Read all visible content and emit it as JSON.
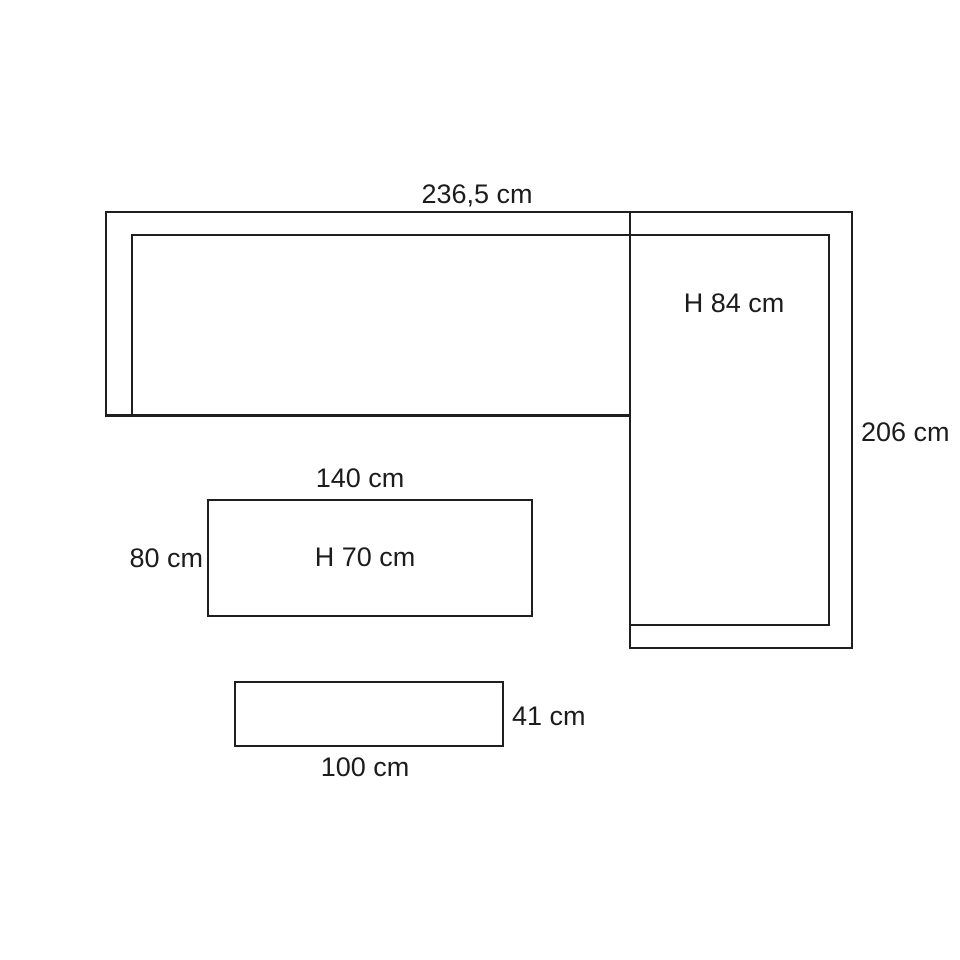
{
  "canvas": {
    "background_color": "#ffffff",
    "line_color": "#1f1f1f"
  },
  "diagram": {
    "type": "furniture-dimension-drawing",
    "corner_sofa": {
      "width_label": "236,5 cm",
      "height_label": "H 84 cm",
      "depth_label": "206 cm"
    },
    "table": {
      "width_label": "140 cm",
      "depth_label": "80 cm",
      "height_label": "H 70 cm"
    },
    "bench": {
      "width_label": "100 cm",
      "height_label": "41 cm"
    }
  }
}
